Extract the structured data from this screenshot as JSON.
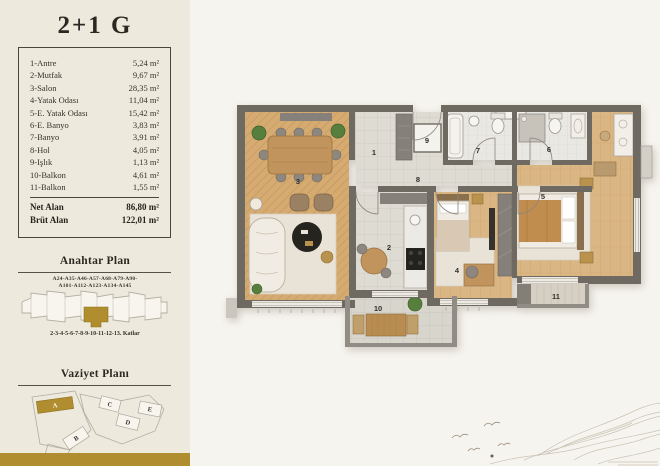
{
  "unit": {
    "title": "2+1 G"
  },
  "rooms": [
    {
      "label": "1-Antre",
      "area": "5,24 m²"
    },
    {
      "label": "2-Mutfak",
      "area": "9,67 m²"
    },
    {
      "label": "3-Salon",
      "area": "28,35 m²"
    },
    {
      "label": "4-Yatak Odası",
      "area": "11,04 m²"
    },
    {
      "label": "5-E. Yatak Odası",
      "area": "15,42 m²"
    },
    {
      "label": "6-E. Banyo",
      "area": "3,83 m²"
    },
    {
      "label": "7-Banyo",
      "area": "3,91 m²"
    },
    {
      "label": "8-Hol",
      "area": "4,05 m²"
    },
    {
      "label": "9-Işlık",
      "area": "1,13 m²"
    },
    {
      "label": "10-Balkon",
      "area": "4,61 m²"
    },
    {
      "label": "11-Balkon",
      "area": "1,55 m²"
    }
  ],
  "totals": [
    {
      "label": "Net Alan",
      "value": "86,80 m²"
    },
    {
      "label": "Brüt Alan",
      "value": "122,01 m²"
    }
  ],
  "key_plan": {
    "title": "Anahtar Plan",
    "codes1": "A24-A35-A46-A57-A68-A79-A90-",
    "codes2": "A101-A112-A123-A134-A145",
    "caption": "2-3-4-5-6-7-8-9-10-11-12-13. Katlar"
  },
  "site_plan": {
    "title": "Vaziyet Planı",
    "blocks": [
      "A",
      "B",
      "C",
      "D",
      "E"
    ],
    "highlighted_block": "A"
  },
  "plan": {
    "labels": [
      "1",
      "2",
      "3",
      "4",
      "5",
      "6",
      "7",
      "8",
      "9",
      "10",
      "11"
    ]
  },
  "colors": {
    "accent_gold": "#b08d2e",
    "wall": "#6f6a61",
    "sidebar_bg": "#edeadd",
    "page_bg": "#f6f4ee"
  }
}
